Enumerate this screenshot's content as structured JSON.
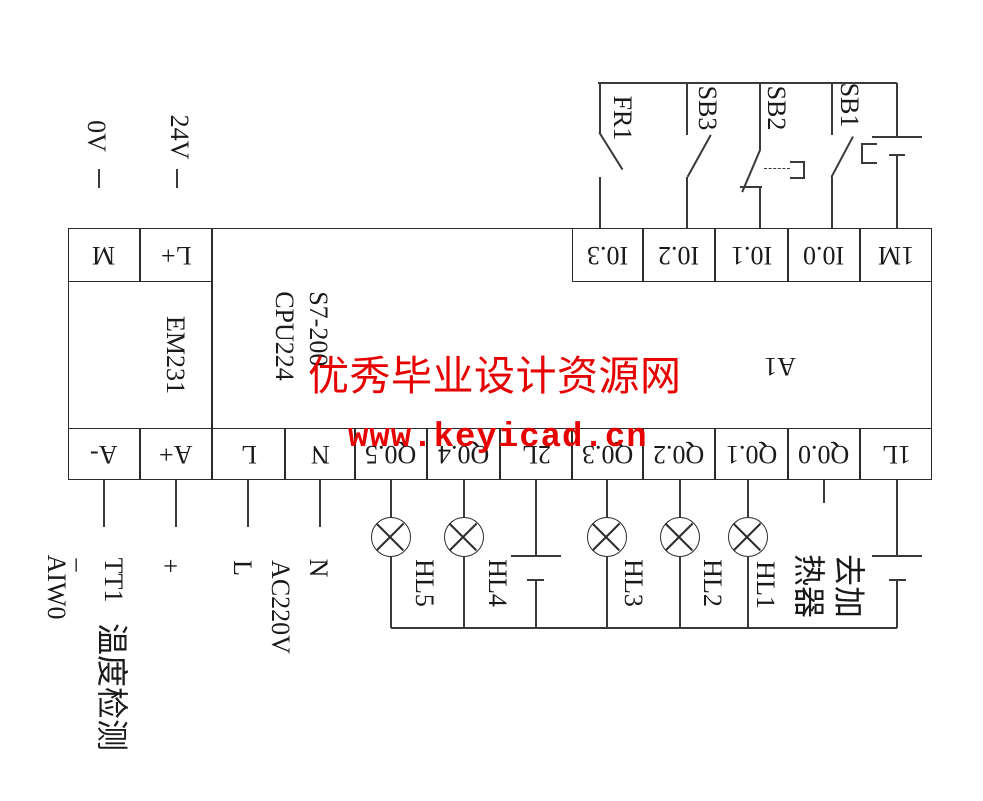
{
  "colors": {
    "watermark": "#e60000",
    "line": "#3a3a3a"
  },
  "watermark": {
    "line1": "优秀毕业设计资源网",
    "line2": "www.keyicad.cn"
  },
  "dc": {
    "v0": "0V",
    "v24": "24V"
  },
  "switches": {
    "fr1": "FR1",
    "sb3": "SB3",
    "sb2": "SB2",
    "sb1": "SB1"
  },
  "modules": {
    "expansion": "EM231",
    "cpu1": "S7-200",
    "cpu2": "CPU224",
    "unit": "A1"
  },
  "terminals": {
    "m": "M",
    "l_plus": "L+",
    "i03": "I0.3",
    "i02": "I0.2",
    "i01": "I0.1",
    "i00": "I0.0",
    "m1": "1M",
    "a_minus": "A-",
    "a_plus": "A+",
    "l": "L",
    "n": "N",
    "q05": "Q0.5",
    "q04": "Q0.4",
    "l2": "2L",
    "q03": "Q0.3",
    "q02": "Q0.2",
    "q01": "Q0.1",
    "q00": "Q0.0",
    "l1": "1L"
  },
  "lamps": {
    "hl5": "HL5",
    "hl4": "HL4",
    "hl3": "HL3",
    "hl2": "HL2",
    "hl1": "HL1"
  },
  "heater": {
    "line1": "去加",
    "line2": "热器"
  },
  "analog": {
    "word": "AIW0",
    "minus": "–",
    "sensor": "TT1",
    "sensor_name": "温度检测",
    "plus": "+"
  },
  "ac": {
    "l": "L",
    "name": "AC220V",
    "n": "N"
  }
}
